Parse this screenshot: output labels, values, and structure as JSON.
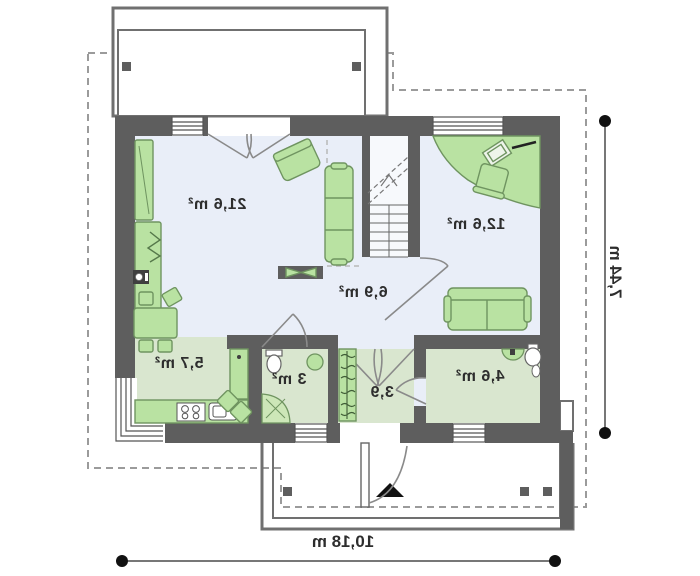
{
  "plan": {
    "type": "floor-plan-mirrored",
    "rooms": [
      {
        "id": "living-room",
        "area_label": "21,6 m²"
      },
      {
        "id": "bedroom",
        "area_label": "12,6 m²"
      },
      {
        "id": "hall",
        "area_label": "6,9 m²"
      },
      {
        "id": "kitchen",
        "area_label": "5,7 m²"
      },
      {
        "id": "bathroom-small",
        "area_label": "3 m²"
      },
      {
        "id": "vestibule",
        "area_label": "3,9"
      },
      {
        "id": "bathroom",
        "area_label": "4,6 m²"
      }
    ],
    "dimensions": {
      "width_label": "10,18 m",
      "height_label": "7,44 m"
    },
    "colors": {
      "wall": "#5e5e5e",
      "floor_main": "#e9eef8",
      "floor_service": "#d9e6cf",
      "furniture_fill": "#b9e2a2",
      "furniture_stroke": "#6f9460",
      "outline": "#707070",
      "roof_dashed": "#9b9b9b",
      "dimension_line": "#4a4a4a",
      "label_text": "#2d2d2d"
    },
    "icons": [
      "sofa-icon",
      "armchair-icon",
      "corner-desk-icon",
      "desk-chair-icon",
      "laptop-icon",
      "dining-table-icon",
      "chair-icon",
      "kitchen-counter-icon",
      "stove-icon",
      "sink-icon",
      "wardrobe-icon",
      "hanger-wardrobe-icon",
      "bookshelf-icon",
      "plant-icon",
      "tv-cabinet-icon",
      "stairs-icon",
      "toilet-icon",
      "shower-icon",
      "washbasin-icon",
      "entrance-arrow-icon",
      "terrace-post-icon",
      "door-swing-icon",
      "window-icon"
    ]
  }
}
